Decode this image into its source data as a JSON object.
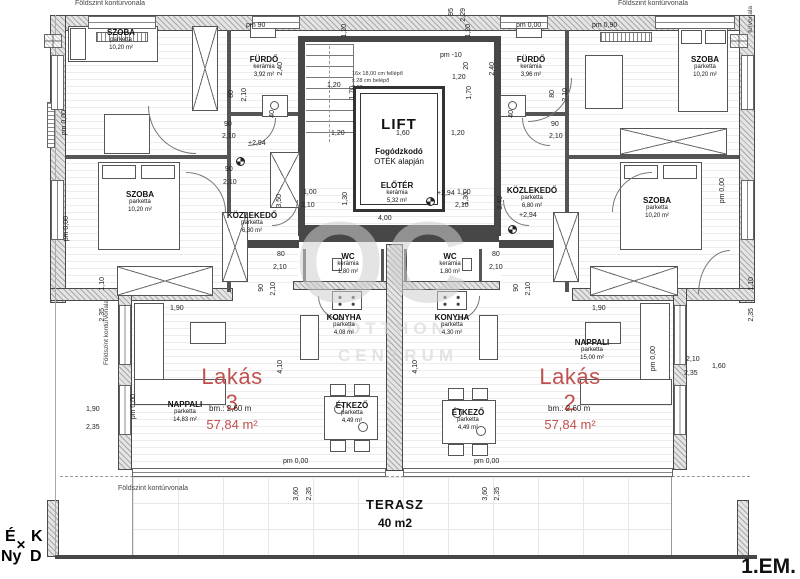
{
  "meta": {
    "floor_label": "1.EM."
  },
  "colors": {
    "accent_red": "#c0504d",
    "wall_dark": "#474747",
    "watermark_gray": "#cfcfcf"
  },
  "watermark": {
    "monogram": "OC",
    "line1": "OTTHON",
    "line2": "CENTRUM"
  },
  "compass": {
    "north": "É",
    "east": "K",
    "west": "Ny",
    "south": "D",
    "cross": "✕"
  },
  "labels": {
    "contour": "Földszint kontúrvonala",
    "contour_fragment": "túrvonala"
  },
  "terrace": {
    "name": "TERASZ",
    "area": "40 m2"
  },
  "lift": {
    "label": "LIFT",
    "note_line1": "Fogódzkodó",
    "note_line2": "OTÉK alapján"
  },
  "stairs_note": {
    "line1": "16x 18,00 cm fellépő",
    "line2": "x 28 cm belépő",
    "line3": "2,80 m"
  },
  "apartments": [
    {
      "name": "Lakás 3",
      "area": "57,84 m²",
      "ceiling": "bm.: 2,60 m"
    },
    {
      "name": "Lakás 2",
      "area": "57,84 m²",
      "ceiling": "bm.: 2,60 m"
    }
  ],
  "rooms": [
    {
      "id": "szoba-top-left",
      "name": "SZOBA",
      "material": "parketta",
      "area": "10,20 m²",
      "x": 121,
      "y": 28
    },
    {
      "id": "furdo-left",
      "name": "FÜRDŐ",
      "material": "kerámia",
      "area": "3,92 m²",
      "x": 264,
      "y": 55
    },
    {
      "id": "szoba-mid-left",
      "name": "SZOBA",
      "material": "parketta",
      "area": "10,20 m²",
      "x": 140,
      "y": 190
    },
    {
      "id": "kozlekedo-left",
      "name": "KÖZLEKEDŐ",
      "material": "parketta",
      "area": "6,30 m²",
      "x": 252,
      "y": 211
    },
    {
      "id": "wc-left",
      "name": "WC",
      "material": "kerámia",
      "area": "1,80 m²",
      "x": 348,
      "y": 252
    },
    {
      "id": "konyha-left",
      "name": "KONYHA",
      "material": "parketta",
      "area": "4,08 m²",
      "x": 344,
      "y": 313
    },
    {
      "id": "etkezo-left",
      "name": "ÉTKEZŐ",
      "material": "parketta",
      "area": "4,49 m²",
      "x": 352,
      "y": 401
    },
    {
      "id": "nappali-left",
      "name": "NAPPALI",
      "material": "parketta",
      "area": "14,83 m²",
      "x": 185,
      "y": 400
    },
    {
      "id": "eloter",
      "name": "ELŐTÉR",
      "material": "kerámia",
      "area": "5,32 m²",
      "x": 397,
      "y": 181
    },
    {
      "id": "furdo-right",
      "name": "FÜRDŐ",
      "material": "kerámia",
      "area": "3,96 m²",
      "x": 531,
      "y": 55
    },
    {
      "id": "szoba-top-right",
      "name": "SZOBA",
      "material": "parketta",
      "area": "10,20 m²",
      "x": 705,
      "y": 55
    },
    {
      "id": "szoba-mid-right",
      "name": "SZOBA",
      "material": "parketta",
      "area": "10,20 m²",
      "x": 657,
      "y": 196
    },
    {
      "id": "kozlekedo-right",
      "name": "KÖZLEKEDŐ",
      "material": "parketta",
      "area": "6,80 m²",
      "x": 532,
      "y": 186
    },
    {
      "id": "wc-right",
      "name": "WC",
      "material": "kerámia",
      "area": "1,80 m²",
      "x": 450,
      "y": 252
    },
    {
      "id": "konyha-right",
      "name": "KONYHA",
      "material": "parketta",
      "area": "4,30 m²",
      "x": 452,
      "y": 313
    },
    {
      "id": "etkezo-right",
      "name": "ÉTKEZŐ",
      "material": "parketta",
      "area": "4,49 m²",
      "x": 468,
      "y": 408
    },
    {
      "id": "nappali-right",
      "name": "NAPPALI",
      "material": "parketta",
      "area": "15,00 m²",
      "x": 592,
      "y": 338
    }
  ],
  "dims": [
    {
      "t": "pm 90",
      "x": 246,
      "y": 22,
      "r": 0
    },
    {
      "t": "pm 0,00",
      "x": 516,
      "y": 22,
      "r": 0
    },
    {
      "t": "pm 0,90",
      "x": 592,
      "y": 22,
      "r": 0
    },
    {
      "t": "95",
      "x": 448,
      "y": 8,
      "r": 1
    },
    {
      "t": "2,29",
      "x": 460,
      "y": 8,
      "r": 1
    },
    {
      "t": "pm -10",
      "x": 440,
      "y": 52,
      "r": 0
    },
    {
      "t": "20",
      "x": 463,
      "y": 62,
      "r": 1
    },
    {
      "t": "1,20",
      "x": 341,
      "y": 24,
      "r": 1
    },
    {
      "t": "1,20",
      "x": 465,
      "y": 24,
      "r": 1
    },
    {
      "t": "1,20",
      "x": 327,
      "y": 82,
      "r": 0
    },
    {
      "t": "1,70",
      "x": 349,
      "y": 86,
      "r": 1
    },
    {
      "t": "1,20",
      "x": 452,
      "y": 74,
      "r": 0
    },
    {
      "t": "1,70",
      "x": 466,
      "y": 86,
      "r": 1
    },
    {
      "t": "1,20",
      "x": 331,
      "y": 130,
      "r": 0
    },
    {
      "t": "1,60",
      "x": 396,
      "y": 130,
      "r": 0
    },
    {
      "t": "1,20",
      "x": 451,
      "y": 130,
      "r": 0
    },
    {
      "t": "80",
      "x": 228,
      "y": 90,
      "r": 1
    },
    {
      "t": "2,10",
      "x": 241,
      "y": 88,
      "r": 1
    },
    {
      "t": "90",
      "x": 224,
      "y": 121,
      "r": 0
    },
    {
      "t": "2,10",
      "x": 222,
      "y": 133,
      "r": 0
    },
    {
      "t": "80",
      "x": 549,
      "y": 90,
      "r": 1
    },
    {
      "t": "2,10",
      "x": 562,
      "y": 88,
      "r": 1
    },
    {
      "t": "90",
      "x": 551,
      "y": 121,
      "r": 0
    },
    {
      "t": "2,10",
      "x": 549,
      "y": 133,
      "r": 0
    },
    {
      "t": "+2,94",
      "x": 248,
      "y": 140,
      "r": 0
    },
    {
      "t": "90",
      "x": 225,
      "y": 166,
      "r": 0
    },
    {
      "t": "2,10",
      "x": 223,
      "y": 179,
      "r": 0
    },
    {
      "t": "1,00",
      "x": 303,
      "y": 189,
      "r": 0
    },
    {
      "t": "2,10",
      "x": 301,
      "y": 202,
      "r": 0
    },
    {
      "t": "1,30",
      "x": 342,
      "y": 192,
      "r": 1
    },
    {
      "t": "3,50",
      "x": 276,
      "y": 194,
      "r": 1
    },
    {
      "t": "4,00",
      "x": 378,
      "y": 215,
      "r": 0
    },
    {
      "t": "1,00",
      "x": 457,
      "y": 189,
      "r": 0
    },
    {
      "t": "2,10",
      "x": 455,
      "y": 202,
      "r": 0
    },
    {
      "t": "1,30",
      "x": 463,
      "y": 192,
      "r": 1
    },
    {
      "t": "3,40",
      "x": 497,
      "y": 196,
      "r": 1
    },
    {
      "t": "+2,94",
      "x": 437,
      "y": 190,
      "r": 0
    },
    {
      "t": "+2,94",
      "x": 519,
      "y": 212,
      "r": 0
    },
    {
      "t": "2,40",
      "x": 277,
      "y": 62,
      "r": 1
    },
    {
      "t": "40",
      "x": 269,
      "y": 110,
      "r": 1
    },
    {
      "t": "2,40",
      "x": 489,
      "y": 62,
      "r": 1
    },
    {
      "t": "40",
      "x": 508,
      "y": 110,
      "r": 1
    },
    {
      "t": "80",
      "x": 277,
      "y": 251,
      "r": 0
    },
    {
      "t": "2,10",
      "x": 273,
      "y": 264,
      "r": 0
    },
    {
      "t": "80",
      "x": 492,
      "y": 251,
      "r": 0
    },
    {
      "t": "2,10",
      "x": 489,
      "y": 264,
      "r": 0
    },
    {
      "t": "90",
      "x": 258,
      "y": 284,
      "r": 1
    },
    {
      "t": "2,10",
      "x": 270,
      "y": 282,
      "r": 1
    },
    {
      "t": "90",
      "x": 513,
      "y": 284,
      "r": 1
    },
    {
      "t": "2,10",
      "x": 525,
      "y": 282,
      "r": 1
    },
    {
      "t": "4,10",
      "x": 277,
      "y": 360,
      "r": 1
    },
    {
      "t": "4,10",
      "x": 412,
      "y": 360,
      "r": 1
    },
    {
      "t": "1,90",
      "x": 170,
      "y": 305,
      "r": 0
    },
    {
      "t": "1,90",
      "x": 592,
      "y": 305,
      "r": 0
    },
    {
      "t": "1,10",
      "x": 99,
      "y": 277,
      "r": 1
    },
    {
      "t": "2,35",
      "x": 99,
      "y": 308,
      "r": 1
    },
    {
      "t": "1,90",
      "x": 86,
      "y": 406,
      "r": 0
    },
    {
      "t": "2,35",
      "x": 86,
      "y": 424,
      "r": 0
    },
    {
      "t": "pm 0,00",
      "x": 130,
      "y": 394,
      "r": 1
    },
    {
      "t": "1,10",
      "x": 748,
      "y": 277,
      "r": 1
    },
    {
      "t": "2,35",
      "x": 748,
      "y": 308,
      "r": 1
    },
    {
      "t": "2,10",
      "x": 686,
      "y": 356,
      "r": 0
    },
    {
      "t": "2,35",
      "x": 684,
      "y": 370,
      "r": 0
    },
    {
      "t": "1,60",
      "x": 712,
      "y": 363,
      "r": 0
    },
    {
      "t": "pm 0,00",
      "x": 719,
      "y": 178,
      "r": 1
    },
    {
      "t": "pm 0,00",
      "x": 650,
      "y": 346,
      "r": 1
    },
    {
      "t": "pm 0,00",
      "x": 283,
      "y": 458,
      "r": 0
    },
    {
      "t": "pm 0,00",
      "x": 474,
      "y": 458,
      "r": 0
    },
    {
      "t": "3,60",
      "x": 293,
      "y": 487,
      "r": 1
    },
    {
      "t": "2,35",
      "x": 306,
      "y": 487,
      "r": 1
    },
    {
      "t": "3,60",
      "x": 482,
      "y": 487,
      "r": 1
    },
    {
      "t": "2,35",
      "x": 494,
      "y": 487,
      "r": 1
    },
    {
      "t": "pm 0,00",
      "x": 61,
      "y": 110,
      "r": 1
    },
    {
      "t": "pm 0,00",
      "x": 63,
      "y": 216,
      "r": 1
    }
  ]
}
